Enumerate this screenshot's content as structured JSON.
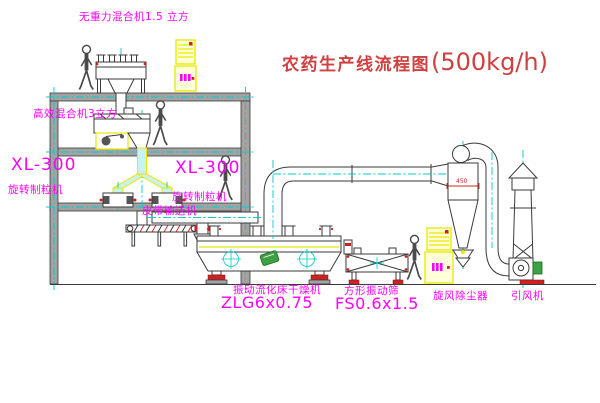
{
  "title": {
    "text": "农药生产线流程图",
    "capacity": "(500kg/h)"
  },
  "labels": {
    "gravity_mixer": "无重力混合机1.5 立方",
    "high_efficiency_mixer": "高效混合机3立方",
    "granulator_left_model": "XL-300",
    "granulator_left_name": "旋转制粒机",
    "granulator_right_model": "XL-300",
    "granulator_right_name": "旋转制粒机",
    "belt_conveyor": "皮带输送机",
    "dryer_name": "振动流化床干燥机",
    "dryer_model": "ZLG6x0.75",
    "sieve_name": "方形振动筛",
    "sieve_model": "FS0.6x1.5",
    "cyclone": "旋风除尘器",
    "induced_draft_fan": "引风机",
    "cyclone_dimension": "450"
  },
  "colors": {
    "label_magenta": "#ff00ff",
    "title_red": "#d04040",
    "centerline_cyan": "#00cccc",
    "cabinet_yellow": "#e8e800",
    "accent_red": "#cc2222",
    "motor_green": "#3fa044",
    "structure_gray": "#a3a3a3",
    "line_dark": "#3a3a3a"
  },
  "icons": [
    "person-icon",
    "control-cabinet-icon",
    "cyclone-separator-machine",
    "exhaust-stack",
    "induced-draft-fan-machine"
  ]
}
